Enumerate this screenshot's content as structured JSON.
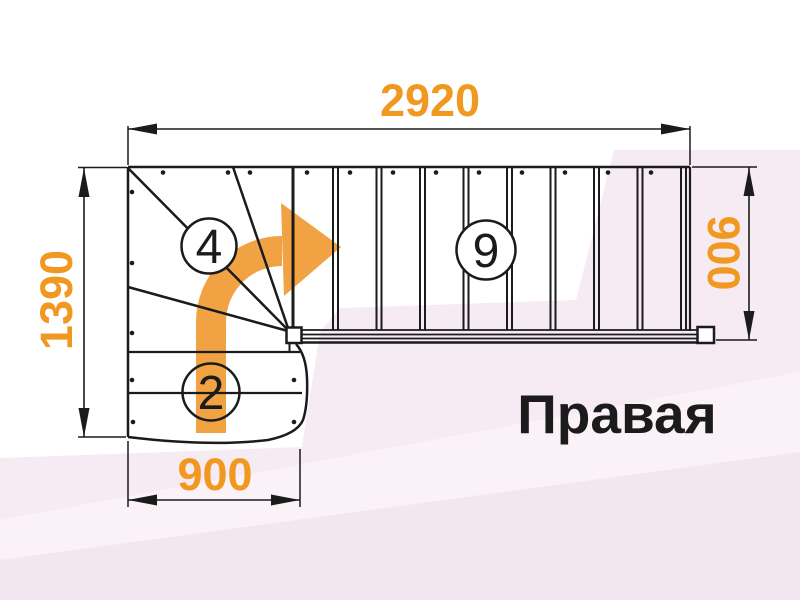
{
  "drawing": {
    "dim_top": "2920",
    "dim_left": "1390",
    "dim_right": "900",
    "dim_bottom": "900",
    "badge_winder_steps": "4",
    "badge_main_steps": "9",
    "badge_entry_steps": "2",
    "variant_label": "Правая",
    "colors": {
      "dimension_text": "#F0981F",
      "arrow_fill": "#F1A242",
      "line": "#1B1B1B",
      "bg_tint_main": "#F7EBF3",
      "bg_tint_light": "#FBF2F8",
      "bg_tint_dark": "#F3E7EF"
    }
  }
}
